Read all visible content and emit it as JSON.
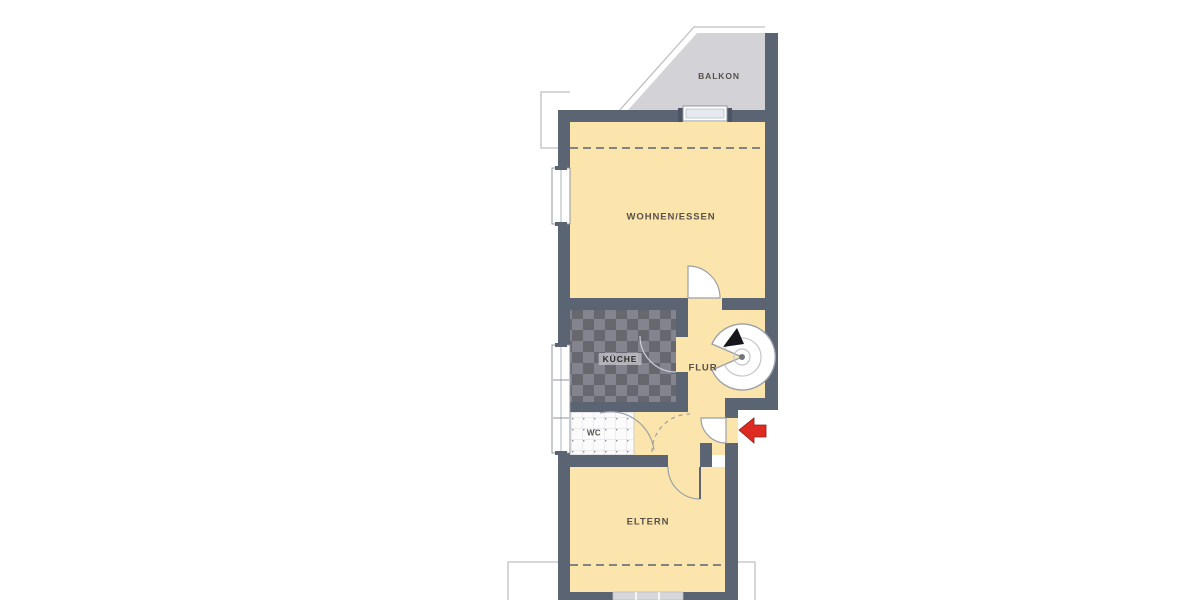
{
  "title": {
    "text": "OBERGESCHOSS"
  },
  "rooms": [
    {
      "name": "BALKON"
    },
    {
      "name": "WOHNEN/ESSEN"
    },
    {
      "name": "KÜCHE"
    },
    {
      "name": "FLUR"
    },
    {
      "name": "WC"
    },
    {
      "name": "ELTERN"
    }
  ],
  "icons": {
    "entrance_arrow": "red-entrance-arrow-pointing-left",
    "staircase": "spiral-staircase-symbol",
    "stair_direction": "black-up-triangle"
  },
  "colors": {
    "wall": "#5b6472",
    "room_fill": "#fbe5ad",
    "balcony_fill": "#d3d3d7",
    "kitchen_tile_dark": "#67676f",
    "kitchen_tile_light": "#84848e",
    "wc_tile": "#fbfbfb",
    "entrance_arrow": "#dd2b22",
    "dashed_line": "#5b6472",
    "outline_thin": "#bcbfc3",
    "title_text": "#a8abaf",
    "label_text": "#57514a"
  }
}
